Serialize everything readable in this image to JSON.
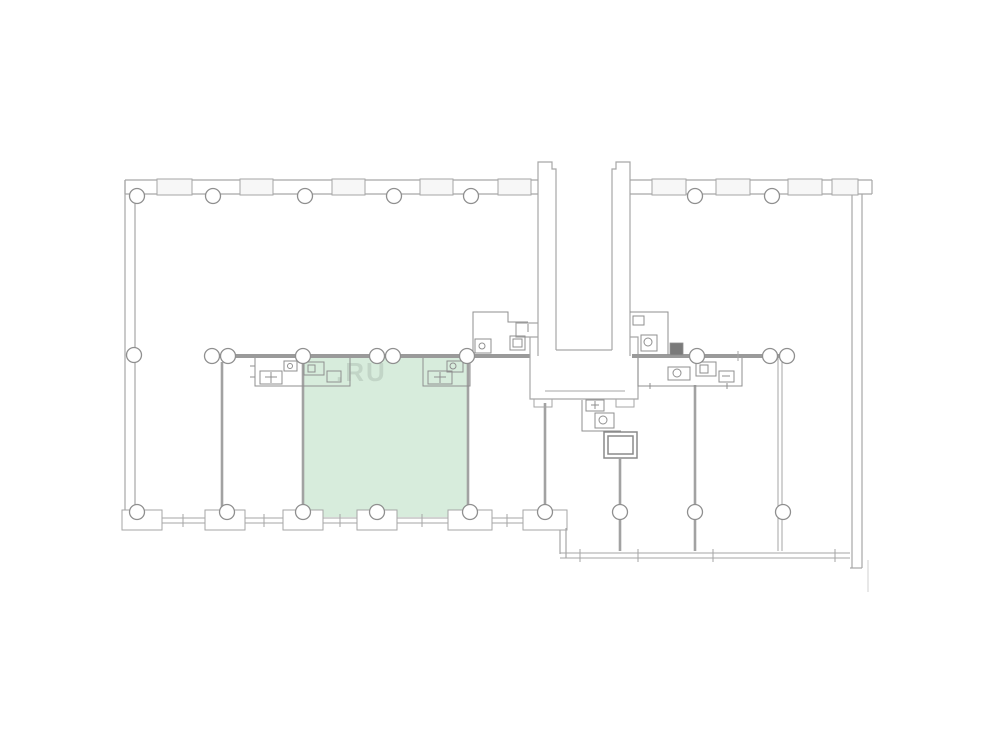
{
  "page": {
    "type": "floor-plan-viewer",
    "title": ""
  },
  "watermark": {
    "text": ".RU"
  },
  "plan": {
    "highlighted_room": {
      "name": "selected-apartment",
      "shape": "rectangle",
      "highlighted": true
    },
    "features": {
      "left_wing_top_columns": 5,
      "right_wing_top_columns": 2,
      "corridor_columns": 9,
      "bottom_grid_columns": 9,
      "central_core": "stair-and-elevator-shaft",
      "bathroom_blocks": 6
    },
    "colors": {
      "background": "#ffffff",
      "wall": "#a6a6a6",
      "wallThick": "#9a9a9a",
      "wallMid": "#a2a2a2",
      "windowFill": "#f7f7f7",
      "columnFill": "#ffffff",
      "columnStroke": "#8f8f8f",
      "fixture": "#8f8f8f",
      "shaft": "#8a8a8a",
      "doorDark": "#7a7a7a",
      "highlight": "#d7ecdc",
      "watermark": "#b2c4b6"
    }
  }
}
